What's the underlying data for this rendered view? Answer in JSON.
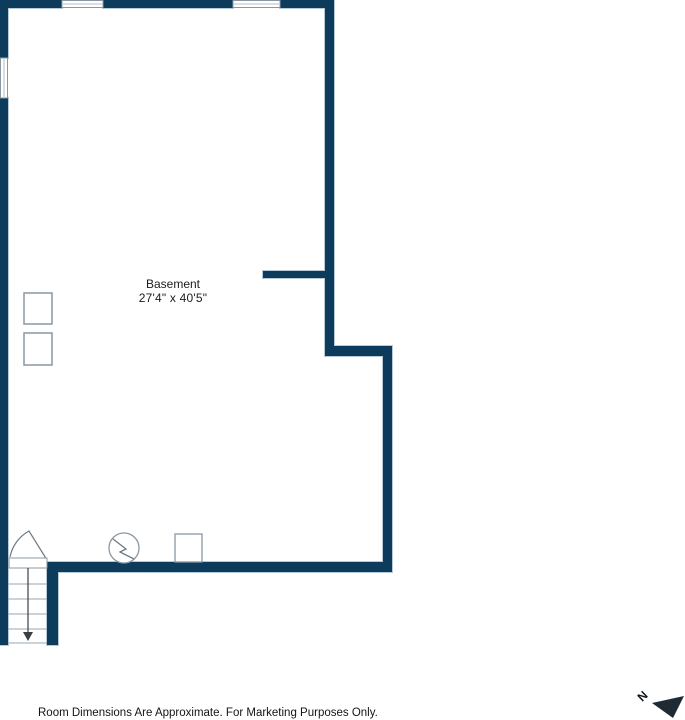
{
  "floor_plan": {
    "room": {
      "name": "Basement",
      "dimensions": "27'4\" x 40'5\""
    },
    "disclaimer": "Room Dimensions Are Approximate. For Marketing Purposes Only.",
    "compass": {
      "label": "N"
    },
    "colors": {
      "wall": "#0d3b5c",
      "wall_outline": "#b6c9d8",
      "symbol_outline": "#8a97a3",
      "tread_line": "#9aa7b2",
      "compass_arrow": "#1f2a33",
      "text": "#1c1c1c"
    },
    "symbols": [
      "window",
      "door-swing",
      "staircase-down-arrow",
      "water-heater",
      "furnace",
      "support-post",
      "north-arrow"
    ]
  }
}
